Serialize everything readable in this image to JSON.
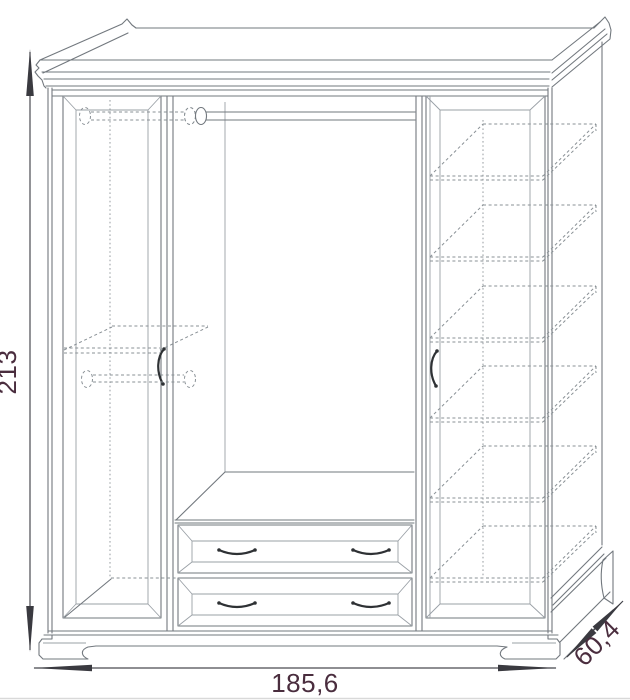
{
  "diagram": {
    "type": "furniture-technical-drawing",
    "subject": "three-section wardrobe, front view with hidden interior lines and overall dimensions",
    "dimensions": {
      "height": "213",
      "width": "185,6",
      "depth": "60,4"
    },
    "components": {
      "doors": 2,
      "open_sections": 1,
      "drawers": 2,
      "door_handles": 2,
      "drawer_handles": 4,
      "hanging_rods": 3,
      "right_section_shelves": 6
    },
    "colors": {
      "background": "#ffffff",
      "outline": "#72787e",
      "hidden_line": "#8a9196",
      "dimension_line": "#4a4b52",
      "dimension_arrow": "#3a3a40",
      "dimension_text": "#4a2d3e",
      "handle": "#2e3134"
    }
  }
}
